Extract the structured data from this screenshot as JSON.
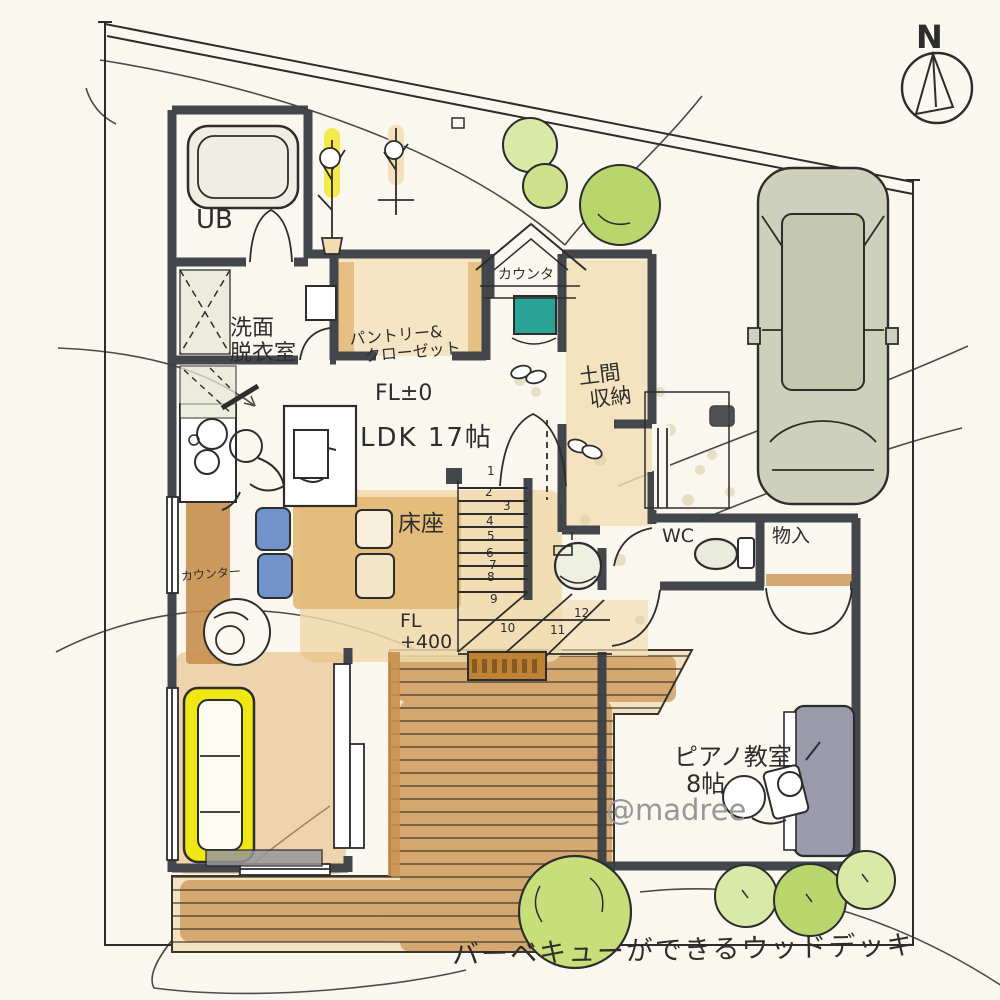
{
  "colors": {
    "paper": "#faf7ef",
    "ink": "#2d2d2d",
    "wall": "#3b4045",
    "tan": "#e3b877",
    "tanLight": "#f2ddb2",
    "deck": "#cd9a5c",
    "counter": "#c78f4c",
    "yellow": "#f1e714",
    "teal": "#28a395",
    "blue": "#7392cb",
    "green": "#b9d66d",
    "greenLight": "#d9e9a8",
    "car": "#cdd1bb",
    "piano": "#9b9bab",
    "gray": "#97979b"
  },
  "compass": {
    "north": "N"
  },
  "watermark": "@madree",
  "notes": {
    "deck": "バーベキューができるウッドデッキ"
  },
  "rooms": {
    "ub": "UB",
    "washroom": [
      "洗面",
      "脱衣室"
    ],
    "pantry": [
      "パントリー&",
      "クローゼット"
    ],
    "doma": [
      "土間",
      "収納"
    ],
    "wc": "WC",
    "storage": "物入",
    "piano": [
      "ピアノ教室",
      "8帖"
    ],
    "ldk": "LDK 17帖",
    "yukaza": "床座"
  },
  "levels": {
    "fl_zero": "FL±0",
    "fl_raised": [
      "FL",
      "+400"
    ]
  },
  "counters": {
    "entrance": "カウンタ",
    "kitchen": "カウンター"
  },
  "stairs": {
    "steps": [
      "1",
      "2",
      "3",
      "4",
      "5",
      "6",
      "7",
      "8",
      "9",
      "10",
      "11",
      "12"
    ]
  }
}
